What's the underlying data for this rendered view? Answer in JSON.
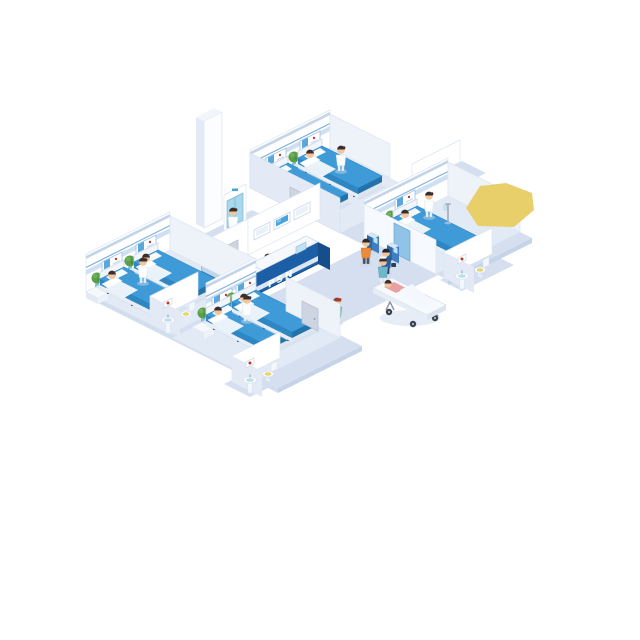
{
  "meta": {
    "title": "Isometric hospital ward illustration",
    "background": "#ffffff"
  },
  "reception": {
    "desk_label": "PSN"
  },
  "scene": {
    "rooms": [
      {
        "name": "top patient room",
        "beds": 2,
        "patients": 2,
        "staff": 1,
        "plants": 1,
        "ensuite_bathroom": true
      },
      {
        "name": "left patient room",
        "beds": 2,
        "patients": 2,
        "staff": 1,
        "plants": 2,
        "ensuite_bathroom": true
      },
      {
        "name": "bottom patient room",
        "beds": 2,
        "patients": 2,
        "staff": 1,
        "plants": 2,
        "ensuite_bathroom": true
      },
      {
        "name": "right patient room",
        "beds": 1,
        "patients": 1,
        "staff": 1,
        "plants": 1,
        "ensuite_bathroom": true
      }
    ],
    "corridor": {
      "reception_desk": true,
      "wall_mounted_screens": 3,
      "checkin_kiosks": 2,
      "kiosk_users": 2,
      "elevator": true,
      "stretcher_with_patient": true,
      "walking_people": 4
    },
    "highlight": "yellow polygon over right wing wall"
  },
  "colors": {
    "page-bg": "#ffffff",
    "floor": "#d5dff0",
    "floor-room": "#e2eaf6",
    "floor-rim": "#c6d4e8",
    "wall-face": "#ffffff",
    "wall-side": "#e3eaf5",
    "wall-light": "#eef3fa",
    "wall-edge": "#c3d4ea",
    "rail": "#cfe0f2",
    "rail-line": "#7fb0de",
    "bed-blue": "#3f9bd8",
    "bed-blue-side": "#2e86c3",
    "bed-blue-foot": "#2373ab",
    "desk-blue": "#1c5fa6",
    "screen-blue": "#49a3dc",
    "glass-blue": "#8fc3e8",
    "elevator-door": "#a8d8ec",
    "kiosk-blue": "#3f7fc1",
    "plant-green": "#5a9e4a",
    "basin-teal": "#bfe0ea",
    "skin": "#f0c59e",
    "suit-navy": "#2b5f9e",
    "scrub-green": "#8bc4a5",
    "scrub-teal": "#6fb8c9",
    "hair-dark": "#3a2e2a",
    "hair-red": "#a03c2e",
    "accent-red": "#c0392b",
    "shirt-orange": "#e98b3a",
    "shirt-pink": "#e8a0a0",
    "door-gray": "#cdd5e2",
    "highlight-yellow": "#e8cf6a"
  }
}
